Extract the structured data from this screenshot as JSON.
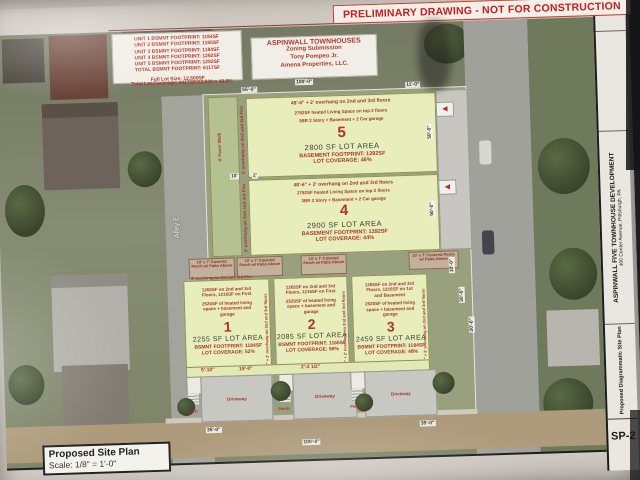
{
  "banner": {
    "text": "PRELIMINARY DRAWING - NOT FOR CONSTRUCTION"
  },
  "unit_summary": {
    "lines": [
      "UNIT 1 BSMNT FOOTPRINT: 1184SF",
      "UNIT 2 BSMNT FOOTPRINT: 1165SF",
      "UNIT 3 BSMNT FOOTPRINT: 1184SF",
      "UNIT 4 BSMNT FOOTPRINT: 1292SF",
      "UNIT 5 BSMNT FOOTPRINT: 1292SF",
      "TOTAL BSMNT FOOTPRINT: 6117SF"
    ],
    "full_lot": "Full Lot Size: 12,500SF",
    "coverage": "Total Lot Coverage: 6117SF/12,500 = 48.9%"
  },
  "project": {
    "title": "ASPINWALL TOWNHOUSES",
    "line2": "Zoning Submission",
    "line3": "Tony Pompeo Jr.",
    "line4": "Amena Properties, LLC."
  },
  "lots": {
    "lot5": {
      "dim_note": "48'-6\" + 2' overhang on 2nd and 3rd floors",
      "living": "2792SF heated Living Space on top 2 floors",
      "type": "3BR 2 Story + Basement + 2 Car garage",
      "number": "5",
      "area": "2800 SF LOT AREA",
      "footprint": "BASEMENT FOOTPRINT: 1292SF",
      "coverage": "LOT COVERAGE: 46%"
    },
    "lot4": {
      "dim_note": "48'-6\" + 2' overhang on 2nd and 3rd floors",
      "living": "2792SF heated Living Space on top 2 floors",
      "type": "3BR 2 Story + Basement + 2 Car garage",
      "number": "4",
      "area": "2900 SF LOT AREA",
      "footprint": "BASEMENT FOOTPRINT: 1292SF",
      "coverage": "LOT COVERAGE: 44%"
    },
    "lot1": {
      "floors": "1265SF on 2nd and 3rd Floors, 1216SF on First",
      "heated": "2520SF of heated living space + basement and garage",
      "number": "1",
      "area": "2255 SF LOT AREA",
      "footprint": "BSMNT FOOTPRINT: 1184SF",
      "coverage": "LOT COVERAGE: 52%",
      "side": "30'-6\" + 2' overhang on 2nd and 3rd floors"
    },
    "lot2": {
      "floors": "1265SF on 2nd and 3rd Floors, 1216SF on First",
      "heated": "2520SF of heated living space + basement and garage",
      "number": "2",
      "area": "2085 SF LOT AREA",
      "footprint": "BSMNT FOOTPRINT: 1165SF",
      "coverage": "LOT COVERAGE: 56%",
      "side": "30'-6\" + 2' overhang on 2nd and 3rd floors"
    },
    "lot3": {
      "floors": "1265SF on 2nd and 3rd Floors, 1216SF on 1st and Basement",
      "heated": "2520SF of heated living space + basement and garage",
      "number": "3",
      "area": "2459 SF LOT AREA",
      "footprint": "BSMNT FOOTPRINT: 1184SF",
      "coverage": "LOT COVERAGE: 48%",
      "side": "30'-6\" + 2' overhang on 2nd and 3rd floors"
    }
  },
  "notes": {
    "porch": "10' x 7' Covered Porch w/ Patio Above",
    "overhang": "2' overhang on 2nd and 3rd Flrs",
    "walk": "4' Paver Walk"
  },
  "streets": {
    "alley": "Alley E"
  },
  "driveways": {
    "label": "Driveway",
    "porch": "Porch"
  },
  "dims": {
    "top_a": "55'-0\"",
    "top_b": "100'-0\"",
    "top_c": "11'-0\"",
    "lot4_a": "10'",
    "lot4_b": "2'",
    "right_a": "10'-0\"",
    "right_b": "30'-6\"",
    "right_c": "20'-0\"",
    "side_50a": "50'-0\"",
    "side_50b": "50'-0\"",
    "drv_a": "5'-10\"",
    "drv_b": "19'-0\"",
    "drv_c": "2'-4 1/2\"",
    "st_a": "35'-0\"",
    "st_b": "100'-0\"",
    "st_c": "35'-0\""
  },
  "footer": {
    "title": "Proposed Site Plan",
    "scale": "Scale: 1/8\" = 1'-0\""
  },
  "titleblock": {
    "project": "ASPINWALL FIVE TOWNHOUSE DEVELOPMENT",
    "address": "400 Center Avenue, Pittsburgh, PA",
    "sheet_title": "Proposed Diagrammatic Site Plan",
    "sheet_no": "SP-2"
  }
}
